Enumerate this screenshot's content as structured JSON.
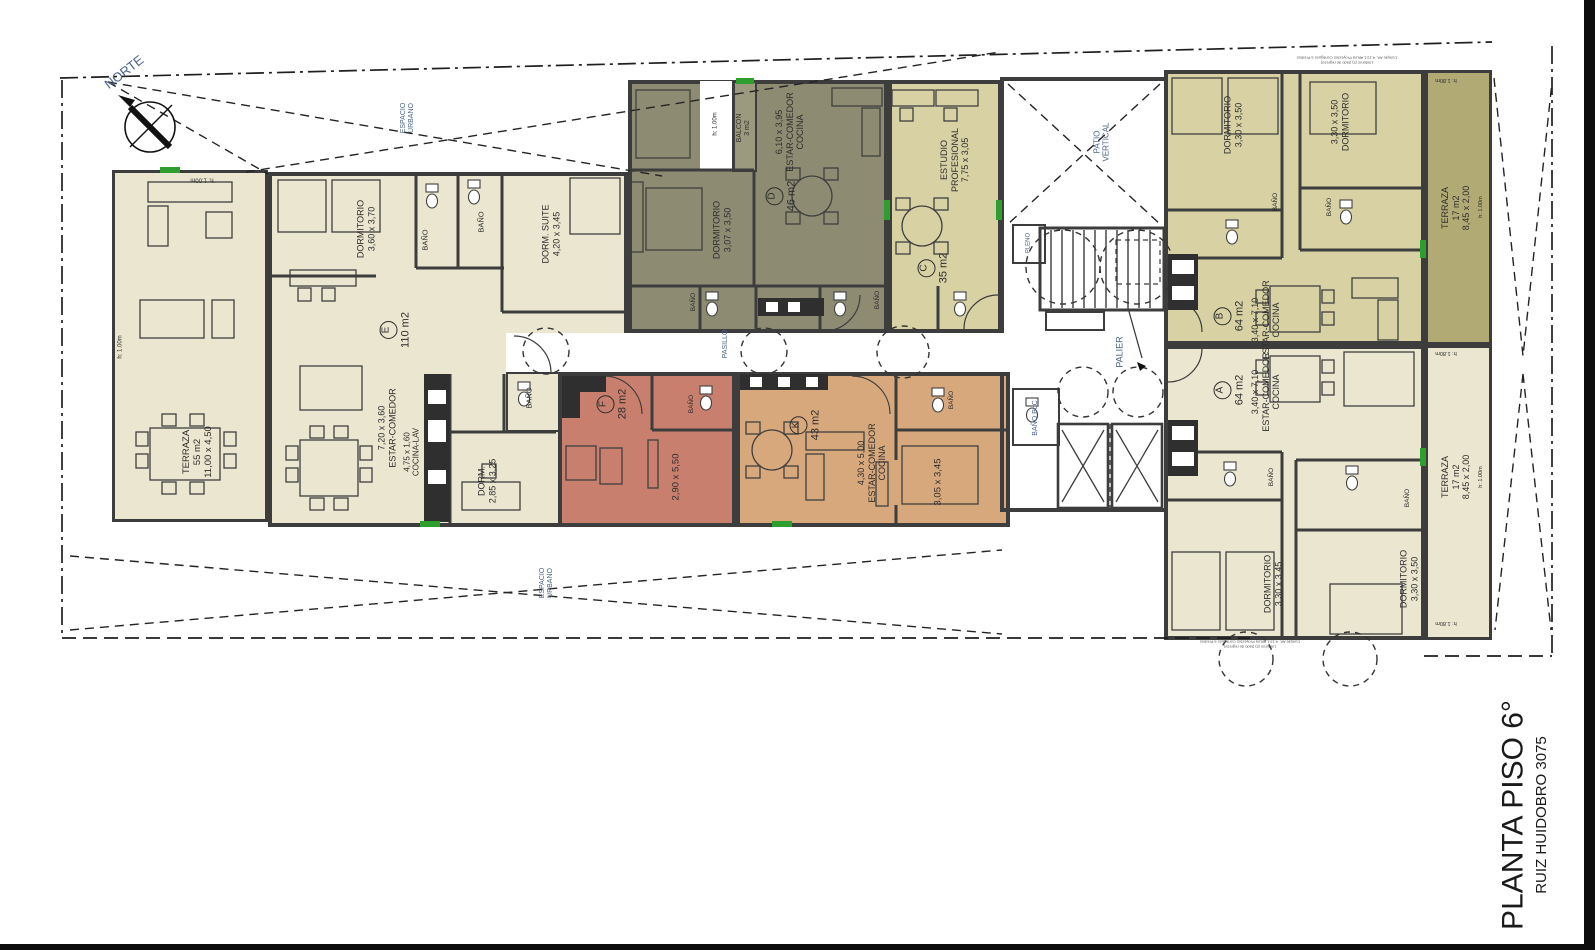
{
  "title_block": {
    "plan_title": "PLANTA PISO 6°",
    "project_address": "RUIZ HUIDOBRO 3075"
  },
  "compass": {
    "north_label": "NORTE"
  },
  "site": {
    "espacio_urbano": {
      "l1": "ESPACIO",
      "l2": "URBANO"
    },
    "patio_vertical": {
      "l1": "PATIO",
      "l2": "VERTICAL"
    },
    "palier": "PALIER",
    "pasillo": "PASILLO",
    "pleno": "PLENO",
    "bano_pdc": "BAÑO PdC",
    "height_note_100": "h: 1.00m",
    "height_note_180": "h: 1.80m",
    "code_note": {
      "l1": "Cumple Art. 4.13.1 Altura Proyectos Contiguos a Predios",
      "l2": "Linderos (s) (lado de regreso)"
    }
  },
  "units": {
    "E": {
      "letter": "E",
      "area": "110 m2",
      "terraza": {
        "name": "TERRAZA",
        "area": "55 m2",
        "dim": "11,00 x 4,50"
      },
      "dormitorio": {
        "name": "DORMITORIO",
        "dim": "3,60 x 3,70"
      },
      "dorm_suite": {
        "name": "DORM. SUITE",
        "dim": "4,20 x 3,45"
      },
      "estar_comedor": {
        "name": "ESTAR-COMEDOR",
        "dim": "7,20 x 3,60"
      },
      "cocina_lav": {
        "name": "COCINA-LAV",
        "dim": "4,75 x 1,60"
      },
      "dorm": {
        "name": "DORM.",
        "dim": "2,85 x 3,25"
      },
      "bano1": "BAÑO",
      "bano2": "BAÑO",
      "bano3": "BAÑO"
    },
    "D": {
      "letter": "D",
      "area": "46 m2",
      "balcon": {
        "name": "BALCON",
        "area": "3 m2"
      },
      "dormitorio": {
        "name": "DORMITORIO",
        "dim": "3,07 x 3,50"
      },
      "estar_comedor": {
        "dim": "6,10 x 3,95",
        "name": "ESTAR-COMEDOR",
        "name2": "COCINA"
      },
      "bano": "BAÑO"
    },
    "C": {
      "letter": "C",
      "area": "35 m2",
      "estudio": {
        "name": "ESTUDIO",
        "name2": "PROFESIONAL",
        "dim": "7,75 x 3,05"
      },
      "bano": "BAÑO"
    },
    "F": {
      "letter": "F",
      "area": "28 m2",
      "dim": "2,90 x 5,50",
      "bano": "BAÑO"
    },
    "K": {
      "letter": "K",
      "area": "43 m2",
      "estar_comedor": {
        "dim": "4,30 x 5,00",
        "name": "ESTAR-COMEDOR",
        "name2": "COCINA"
      },
      "dorm_dim": "3,05 x 3,45",
      "bano": "BAÑO"
    },
    "B": {
      "letter": "B",
      "area": "64 m2",
      "estar_comedor": {
        "dim": "3,40 x 7,10",
        "name": "ESTAR-COMEDOR",
        "name2": "COCINA"
      },
      "dorm1": {
        "name": "DORMITORIO",
        "dim": "3,30 x 3,50"
      },
      "dorm2": {
        "dim": "3,30 x 3,50",
        "name": "DORMITORIO"
      },
      "bano1": "BAÑO",
      "bano2": "BAÑO",
      "terraza": {
        "name": "TERRAZA",
        "area": "17 m2",
        "dim": "8,45 x 2,00"
      }
    },
    "A": {
      "letter": "A",
      "area": "64 m2",
      "estar_comedor": {
        "dim": "3,40 x 7,10",
        "name": "ESTAR-COMEDOR",
        "name2": "COCINA"
      },
      "dorm1": {
        "name": "DORMITORIO",
        "dim": "3,30 x 3,45"
      },
      "dorm2": {
        "name": "DORMITORIO",
        "dim": "3,30 x 3,50"
      },
      "bano1": "BAÑO",
      "bano2": "BAÑO",
      "terraza": {
        "name": "TERRAZA",
        "area": "17 m2",
        "dim": "8,45 x 2,00"
      }
    }
  },
  "colors": {
    "cream": "#eae6d0",
    "olive": "#8d8c72",
    "olive_terrace": "#b2aa74",
    "pale_yellow": "#d7d1a4",
    "salmon": "#c97f6e",
    "tan": "#d8a87d",
    "wall": "#3d3d3d",
    "label_blue": "#4a6288",
    "window_green": "#2e9e2e"
  }
}
